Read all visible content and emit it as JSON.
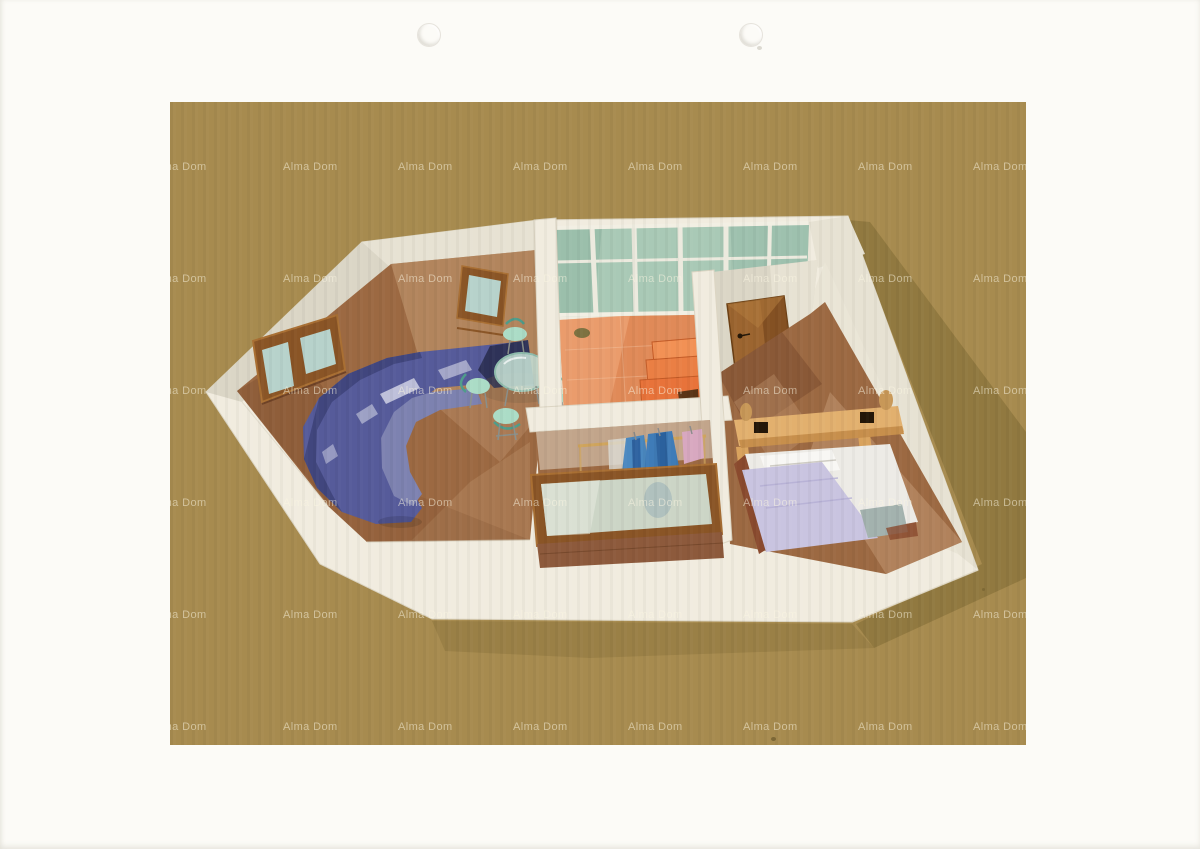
{
  "watermark": {
    "label": "Alma Dom",
    "font_size_px": 11,
    "columns_x": [
      -18,
      113,
      228,
      343,
      458,
      573,
      688,
      803
    ],
    "rows_y": [
      66,
      178,
      290,
      402,
      514,
      626
    ]
  },
  "punch_holes": [
    {
      "x": 417,
      "y": 23
    },
    {
      "x": 739,
      "y": 23
    }
  ],
  "scan_specks": [
    {
      "x": 771,
      "y": 737,
      "w": 5,
      "h": 4,
      "color": "#5a4a22",
      "opacity": 0.55
    },
    {
      "x": 982,
      "y": 588,
      "w": 3,
      "h": 3,
      "color": "#6b5a2a",
      "opacity": 0.5
    },
    {
      "x": 757,
      "y": 46,
      "w": 5,
      "h": 4,
      "color": "#d8d5cc",
      "opacity": 0.9
    }
  ],
  "scene": {
    "description_objects": [
      "apartment-3d-cutaway",
      "living-room",
      "corner-sofa",
      "dining-table",
      "dining-chairs",
      "wall-mirror",
      "double-window",
      "glazed-terrace",
      "terrace-steps",
      "entrance-door",
      "hallway",
      "wardrobe-rail-with-clothes",
      "closet-window",
      "bedroom",
      "double-bed",
      "headboard-shelf",
      "vases"
    ]
  },
  "colors": {
    "paper": "#fcfbf7",
    "tan": "#a78b4f",
    "holeRing": "#e6e3dc",
    "watermark": "rgba(252,246,227,0.52)",
    "shadowOlive": "rgba(88,74,26,0.28)",
    "shadowSoft": "rgba(88,74,26,0.16)",
    "slab": "#f1ecdf",
    "slabEdge": "#dcd5c3",
    "wallFaceLight": "#e7e2d3",
    "wallFace": "#dbd6c6",
    "wallFaceDark": "#cfc9b8",
    "floorWood": "#9c6942",
    "floorWoodLight": "#c59c75",
    "floorWoodDark": "#7e4e30",
    "tile": "#e08a58",
    "tileLight": "#f2ab7e",
    "step1": "#e8733a",
    "step2": "#ea7f44",
    "step3": "#f29155",
    "stepDark": "#c25a26",
    "stepNotch": "#5a3416",
    "glass": "#a9c9b6",
    "glassDark": "#8fb6a2",
    "mullion": "#eceade",
    "frameWood": "#8a5526",
    "frameWoodLight": "#a96f33",
    "paneGlass": "#b7d2cb",
    "sofa": "#565b9a",
    "sofaDark": "#41467e",
    "sofaDarkest": "#2e3258",
    "sofaSeat": "#7d82b0",
    "sofaHighlight": "#d8daea",
    "tableGlass": "#c2dcd2",
    "tableRim": "#8fbcac",
    "chairMint": "#abdcc6",
    "chairTeal": "#4f9c8a",
    "metal": "#8a8f8a",
    "door": "#9c6530",
    "doorDark": "#7e4c20",
    "doorLine": "#6b4015",
    "shelf": "#e2b06e",
    "shelfFront": "#c78f4c",
    "shelfLeg": "#d9a35e",
    "vase": "#c89858",
    "vaseDark": "#241708",
    "bedWhite": "#edebe6",
    "bedLavender": "#c9c4e0",
    "bedTeal": "#a3b2ae",
    "bedFrame": "#8a4a2e",
    "railWood": "#cfa45c",
    "clothesWhite": "#dcdcd4",
    "clothesBlue1": "#4a88c0",
    "clothesBlue1d": "#2e62a0",
    "clothesBlue2": "#3f7cb8",
    "clothesBlue2d": "#275a96",
    "clothesPink": "#d8a8c0",
    "sillBrick": "#8d5a3c",
    "sillDark": "#6e4226",
    "potOlive": "#6b6b3a"
  }
}
